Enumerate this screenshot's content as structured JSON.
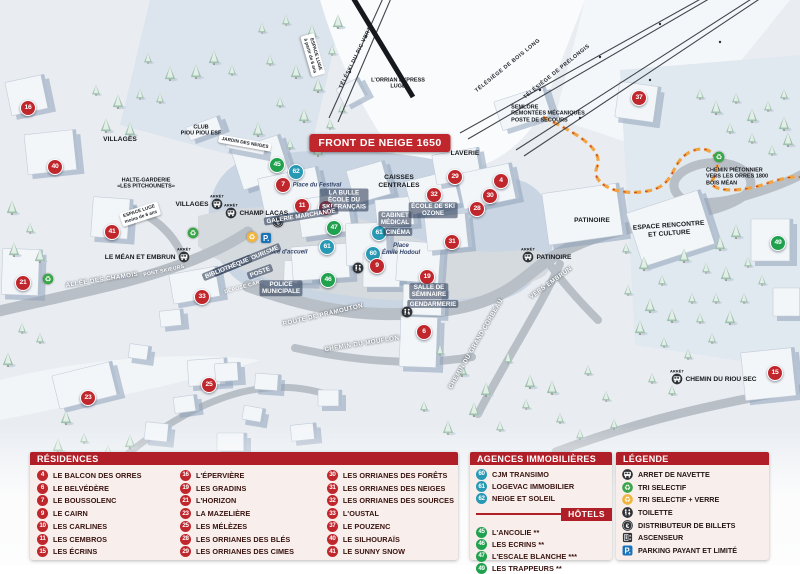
{
  "colors": {
    "brand_red": "#c0272d",
    "header_red": "#b01f27",
    "agency_blue": "#2799b5",
    "hotel_green": "#1fa14d",
    "panel_bg": "#f8eeec",
    "label_dark": "#38130f",
    "path_orange": "#f0a542",
    "parking_blue": "#1a72b8"
  },
  "map": {
    "banner": "FRONT DE NEIGE 1650",
    "arret_label": "ARRÊT",
    "markers": [
      {
        "n": "16",
        "t": "res",
        "x": 28,
        "y": 108
      },
      {
        "n": "40",
        "t": "res",
        "x": 55,
        "y": 167
      },
      {
        "n": "41",
        "t": "res",
        "x": 112,
        "y": 232
      },
      {
        "n": "21",
        "t": "res",
        "x": 23,
        "y": 283
      },
      {
        "n": "23",
        "t": "res",
        "x": 88,
        "y": 398
      },
      {
        "n": "33",
        "t": "res",
        "x": 202,
        "y": 297
      },
      {
        "n": "25",
        "t": "res",
        "x": 209,
        "y": 385
      },
      {
        "n": "45",
        "t": "hot",
        "x": 277,
        "y": 165
      },
      {
        "n": "62",
        "t": "age",
        "x": 296,
        "y": 172
      },
      {
        "n": "7",
        "t": "res",
        "x": 283,
        "y": 185
      },
      {
        "n": "11",
        "t": "res",
        "x": 302,
        "y": 206
      },
      {
        "n": "10",
        "t": "res",
        "x": 326,
        "y": 208
      },
      {
        "n": "47",
        "t": "hot",
        "x": 334,
        "y": 228
      },
      {
        "n": "61",
        "t": "age",
        "x": 327,
        "y": 247
      },
      {
        "n": "61",
        "t": "age",
        "x": 379,
        "y": 233
      },
      {
        "n": "60",
        "t": "age",
        "x": 373,
        "y": 254
      },
      {
        "n": "9",
        "t": "res",
        "x": 377,
        "y": 266
      },
      {
        "n": "46",
        "t": "hot",
        "x": 328,
        "y": 280
      },
      {
        "n": "19",
        "t": "res",
        "x": 427,
        "y": 277
      },
      {
        "n": "6",
        "t": "res",
        "x": 424,
        "y": 332
      },
      {
        "n": "32",
        "t": "res",
        "x": 434,
        "y": 195
      },
      {
        "n": "29",
        "t": "res",
        "x": 455,
        "y": 177
      },
      {
        "n": "4",
        "t": "res",
        "x": 501,
        "y": 181
      },
      {
        "n": "30",
        "t": "res",
        "x": 490,
        "y": 196
      },
      {
        "n": "28",
        "t": "res",
        "x": 477,
        "y": 209
      },
      {
        "n": "31",
        "t": "res",
        "x": 452,
        "y": 242
      },
      {
        "n": "37",
        "t": "res",
        "x": 639,
        "y": 98
      },
      {
        "n": "49",
        "t": "hot",
        "x": 778,
        "y": 243
      },
      {
        "n": "15",
        "t": "res",
        "x": 775,
        "y": 373
      }
    ],
    "stops": [
      {
        "text": "VILLAGES",
        "x": 217,
        "y": 204,
        "side": "left"
      },
      {
        "text": "CHAMP LACAS",
        "x": 231,
        "y": 213,
        "side": "right"
      },
      {
        "text": "LE MÉAN ET EMBRUN",
        "x": 184,
        "y": 257,
        "side": "left"
      },
      {
        "text": "PATINOIRE",
        "x": 528,
        "y": 257,
        "side": "right"
      },
      {
        "text": "CHEMIN DU RIOU SEC",
        "x": 677,
        "y": 379,
        "side": "right"
      }
    ],
    "icons": [
      {
        "type": "recycle-green",
        "x": 48,
        "y": 279
      },
      {
        "type": "recycle-green",
        "x": 193,
        "y": 233
      },
      {
        "type": "recycle-green",
        "x": 719,
        "y": 157
      },
      {
        "type": "recycle-yellow",
        "x": 252,
        "y": 237
      },
      {
        "type": "parking",
        "x": 266,
        "y": 238
      },
      {
        "type": "atm",
        "x": 278,
        "y": 222
      },
      {
        "type": "wc",
        "x": 358,
        "y": 268
      },
      {
        "type": "wc",
        "x": 407,
        "y": 312
      }
    ],
    "labels": [
      {
        "text": "TÉLÉSKI DU PIC VERT",
        "x": 356,
        "y": 58,
        "k": "lift",
        "r": -64
      },
      {
        "text": "TÉLÉSIÈGE DE BOIS LONG",
        "x": 508,
        "y": 66,
        "k": "lift",
        "r": -39
      },
      {
        "text": "TÉLÉSIÈGE DE PRÉLONGIS",
        "x": 557,
        "y": 72,
        "k": "lift",
        "r": -39
      },
      {
        "text": "L'ORRIAN EXPRESS\nLUGE",
        "x": 398,
        "y": 84,
        "k": "poi-sm"
      },
      {
        "text": "SEMLORE\nREMONTÉES MÉCANIQUES\nPOSTE DE SECOURS",
        "x": 548,
        "y": 114,
        "k": "poi-sm",
        "a": "left"
      },
      {
        "text": "ESPACE LUGE\nà partir de 6 ans",
        "x": 313,
        "y": 55,
        "k": "sign",
        "r": 74
      },
      {
        "text": "CLUB\nPIOU PIOU ESF",
        "x": 201,
        "y": 131,
        "k": "poi-sm"
      },
      {
        "text": "JARDIN DES NEIGES",
        "x": 245,
        "y": 143,
        "k": "sign",
        "r": 10
      },
      {
        "text": "HALTE-GARDERIE\n«LES PITCHOUNETS»",
        "x": 146,
        "y": 184,
        "k": "poi-sm"
      },
      {
        "text": "LAVERIE",
        "x": 465,
        "y": 154,
        "k": "poi"
      },
      {
        "text": "CAISSES\nCENTRALES",
        "x": 399,
        "y": 182,
        "k": "poi"
      },
      {
        "text": "Place du Festival",
        "x": 317,
        "y": 186,
        "k": "place"
      },
      {
        "text": "LA BULLE\nÉCOLE DU\nSKI FRANÇAIS",
        "x": 344,
        "y": 200,
        "k": "white"
      },
      {
        "text": "ÉCOLE DE SKI\nOZONE",
        "x": 433,
        "y": 210,
        "k": "white"
      },
      {
        "text": "GALERIE MARCHANDE",
        "x": 301,
        "y": 216,
        "k": "white",
        "r": -9
      },
      {
        "text": "CABINET\nMÉDICAL",
        "x": 395,
        "y": 219,
        "k": "white"
      },
      {
        "text": "CINÉMA",
        "x": 398,
        "y": 232,
        "k": "white"
      },
      {
        "text": "Place\nÉmile Hodoul",
        "x": 401,
        "y": 250,
        "k": "place"
      },
      {
        "text": "Place d'accueil",
        "x": 286,
        "y": 253,
        "k": "place"
      },
      {
        "text": "ESPACE LUGE\nmoins de 6 ans",
        "x": 140,
        "y": 214,
        "k": "sign",
        "r": -18
      },
      {
        "text": "ALLÉE DES CHAMOIS",
        "x": 102,
        "y": 280,
        "k": "road",
        "r": -9
      },
      {
        "text": "PONT SKIEURS",
        "x": 164,
        "y": 271,
        "k": "road-sm",
        "r": -12
      },
      {
        "text": "OFFICE DE TOURISME",
        "x": 247,
        "y": 260,
        "k": "white",
        "r": -22
      },
      {
        "text": "BIBLIOTHÈQUE",
        "x": 227,
        "y": 268,
        "k": "white",
        "r": -22
      },
      {
        "text": "POSTE",
        "x": 260,
        "y": 272,
        "k": "white",
        "r": -20
      },
      {
        "text": "DÉPOSE CARS",
        "x": 244,
        "y": 287,
        "k": "road-sm",
        "r": -16
      },
      {
        "text": "POLICE\nMUNICIPALE",
        "x": 281,
        "y": 288,
        "k": "white"
      },
      {
        "text": "SALLE DE\nSÉMINAIRE",
        "x": 429,
        "y": 291,
        "k": "white"
      },
      {
        "text": "GENDARMERIE",
        "x": 433,
        "y": 304,
        "k": "white"
      },
      {
        "text": "ROUTE DE PRAMOUTON",
        "x": 323,
        "y": 315,
        "k": "road",
        "r": -13
      },
      {
        "text": "CHEMIN DU MOUFLON",
        "x": 362,
        "y": 344,
        "k": "road",
        "r": -9
      },
      {
        "text": "CHEMIN DU GRAND CORBEAU",
        "x": 476,
        "y": 344,
        "k": "road",
        "r": -60
      },
      {
        "text": "VERS EMBRUN",
        "x": 551,
        "y": 283,
        "k": "road",
        "r": -36
      },
      {
        "text": "PATINOIRE",
        "x": 592,
        "y": 221,
        "k": "poi"
      },
      {
        "text": "ESPACE RENCONTRE\nET CULTURE",
        "x": 669,
        "y": 230,
        "k": "poi",
        "r": -4
      },
      {
        "text": "CHEMIN PIÉTONNIER\nVERS LES ORRES 1800\nBOIS MÉAN",
        "x": 737,
        "y": 177,
        "k": "poi-sm",
        "a": "left"
      },
      {
        "text": "VILLAGES",
        "x": 120,
        "y": 140,
        "k": "poi"
      }
    ]
  },
  "panels": {
    "residences": {
      "title": "RÉSIDENCES",
      "columns": [
        [
          [
            "4",
            "LE BALCON DES ORRES"
          ],
          [
            "6",
            "LE BELVÉDÈRE"
          ],
          [
            "7",
            "LE BOUSSOLENC"
          ],
          [
            "9",
            "LE CAIRN"
          ],
          [
            "10",
            "LES CARLINES"
          ],
          [
            "11",
            "LES CEMBROS"
          ],
          [
            "15",
            "LES ÉCRINS"
          ]
        ],
        [
          [
            "16",
            "L'ÉPERVIÈRE"
          ],
          [
            "19",
            "LES GRADINS"
          ],
          [
            "21",
            "L'HORIZON"
          ],
          [
            "23",
            "LA MAZELIÈRE"
          ],
          [
            "25",
            "LES MÉLÈZES"
          ],
          [
            "28",
            "LES ORRIANES DES BLÉS"
          ],
          [
            "29",
            "LES ORRIANES DES CIMES"
          ]
        ],
        [
          [
            "30",
            "LES ORRIANES DES FORÊTS"
          ],
          [
            "31",
            "LES ORRIANES DES NEIGES"
          ],
          [
            "32",
            "LES ORRIANES DES SOURCES"
          ],
          [
            "33",
            "L'OUSTAL"
          ],
          [
            "37",
            "LE POUZENC"
          ],
          [
            "40",
            "LE SILHOURAÏS"
          ],
          [
            "41",
            "LE SUNNY SNOW"
          ]
        ]
      ]
    },
    "agences": {
      "title": "AGENCES IMMOBILIÈRES",
      "items": [
        [
          "60",
          "CJM TRANSIMO"
        ],
        [
          "61",
          "LOGEVAC IMMOBILIER"
        ],
        [
          "62",
          "NEIGE ET SOLEIL"
        ]
      ]
    },
    "hotels": {
      "title": "HÔTELS",
      "items": [
        [
          "45",
          "L'ANCOLIE **"
        ],
        [
          "46",
          "LES ECRINS **"
        ],
        [
          "47",
          "L'ESCALE BLANCHE ***"
        ],
        [
          "49",
          "LES TRAPPEURS **"
        ]
      ]
    },
    "legende": {
      "title": "LÉGENDE",
      "items": [
        [
          "bus",
          "ARRET DE NAVETTE"
        ],
        [
          "recycle-green",
          "TRI SELECTIF"
        ],
        [
          "recycle-yellow",
          "TRI SELECTIF + VERRE"
        ],
        [
          "wc",
          "TOILETTE"
        ],
        [
          "atm",
          "DISTRIBUTEUR DE BILLETS"
        ],
        [
          "elevator",
          "ASCENSEUR"
        ],
        [
          "parking",
          "PARKING PAYANT ET LIMITÉ"
        ]
      ]
    }
  }
}
